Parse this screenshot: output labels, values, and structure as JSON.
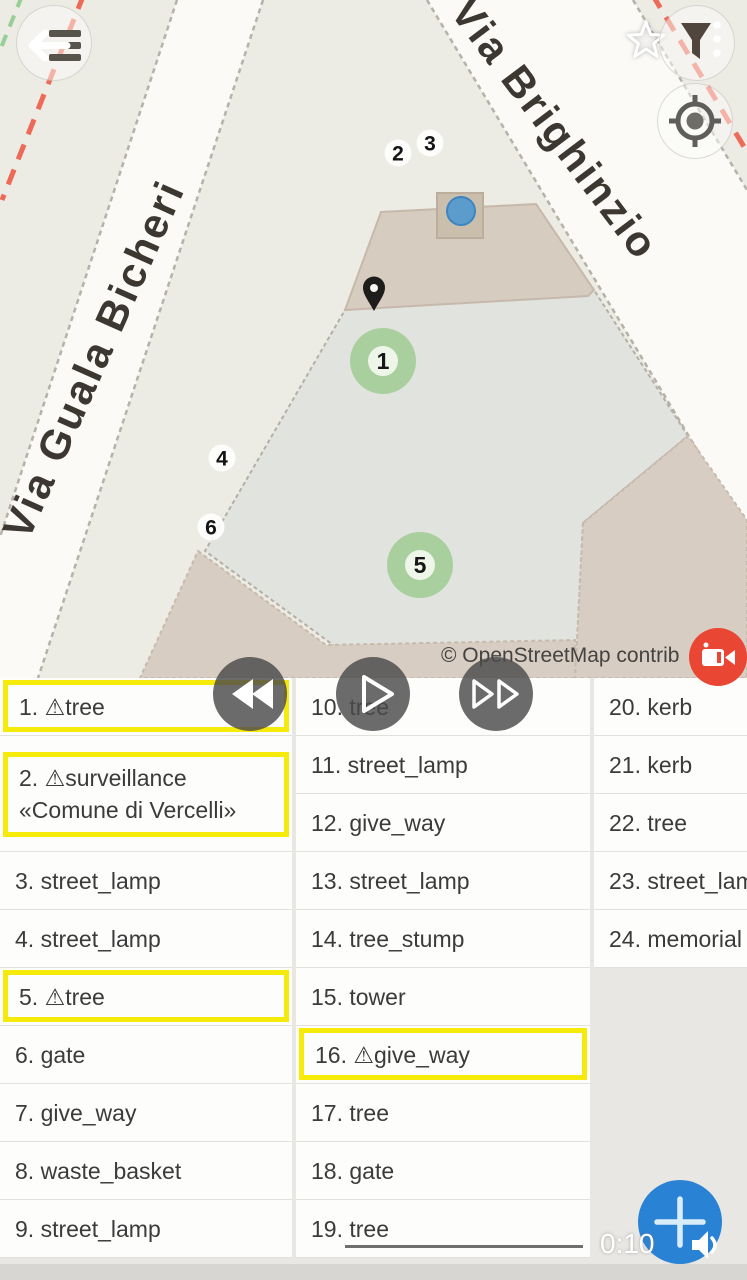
{
  "map": {
    "street_labels": [
      "Via Guala Bicheri",
      "Via Brighinzio"
    ],
    "attribution": "© OpenStreetMap contrib",
    "badges": [
      {
        "n": "2",
        "x": 398,
        "y": 153
      },
      {
        "n": "3",
        "x": 430,
        "y": 143
      },
      {
        "n": "4",
        "x": 222,
        "y": 458
      },
      {
        "n": "6",
        "x": 211,
        "y": 527
      }
    ],
    "green_markers": [
      {
        "n": "1",
        "x": 383,
        "y": 361
      },
      {
        "n": "5",
        "x": 420,
        "y": 565
      }
    ]
  },
  "player": {
    "time": "0:10"
  },
  "fab": {
    "label": "+"
  },
  "list": {
    "warn_glyph": "⚠",
    "columns": [
      [
        {
          "num": "1.",
          "label": "tree",
          "warn": true,
          "highlight": true
        },
        {
          "num": "2.",
          "label": "surveillance",
          "line2": "«Comune di Vercelli»",
          "warn": true,
          "highlight": true
        },
        {
          "num": "3.",
          "label": "street_lamp"
        },
        {
          "num": "4.",
          "label": "street_lamp"
        },
        {
          "num": "5.",
          "label": "tree",
          "warn": true,
          "highlight": true
        },
        {
          "num": "6.",
          "label": "gate"
        },
        {
          "num": "7.",
          "label": "give_way"
        },
        {
          "num": "8.",
          "label": "waste_basket"
        },
        {
          "num": "9.",
          "label": "street_lamp"
        }
      ],
      [
        {
          "num": "10.",
          "label": "tree"
        },
        {
          "num": "11.",
          "label": "street_lamp"
        },
        {
          "num": "12.",
          "label": "give_way"
        },
        {
          "num": "13.",
          "label": "street_lamp"
        },
        {
          "num": "14.",
          "label": "tree_stump"
        },
        {
          "num": "15.",
          "label": "tower"
        },
        {
          "num": "16.",
          "label": "give_way",
          "warn": true,
          "highlight": true
        },
        {
          "num": "17.",
          "label": "tree"
        },
        {
          "num": "18.",
          "label": "gate"
        },
        {
          "num": "19.",
          "label": "tree",
          "underline": true
        }
      ],
      [
        {
          "num": "20.",
          "label": "kerb"
        },
        {
          "num": "21.",
          "label": "kerb"
        },
        {
          "num": "22.",
          "label": "tree"
        },
        {
          "num": "23.",
          "label": "street_lamp"
        },
        {
          "num": "24.",
          "label": "memorial"
        }
      ]
    ]
  },
  "colors": {
    "highlight_yellow": "#f6ea0b",
    "fab_blue": "#2a82d4",
    "record_red": "#e94633",
    "marker_green": "#a6ce99",
    "gps_dot_blue": "#4f98d0"
  }
}
